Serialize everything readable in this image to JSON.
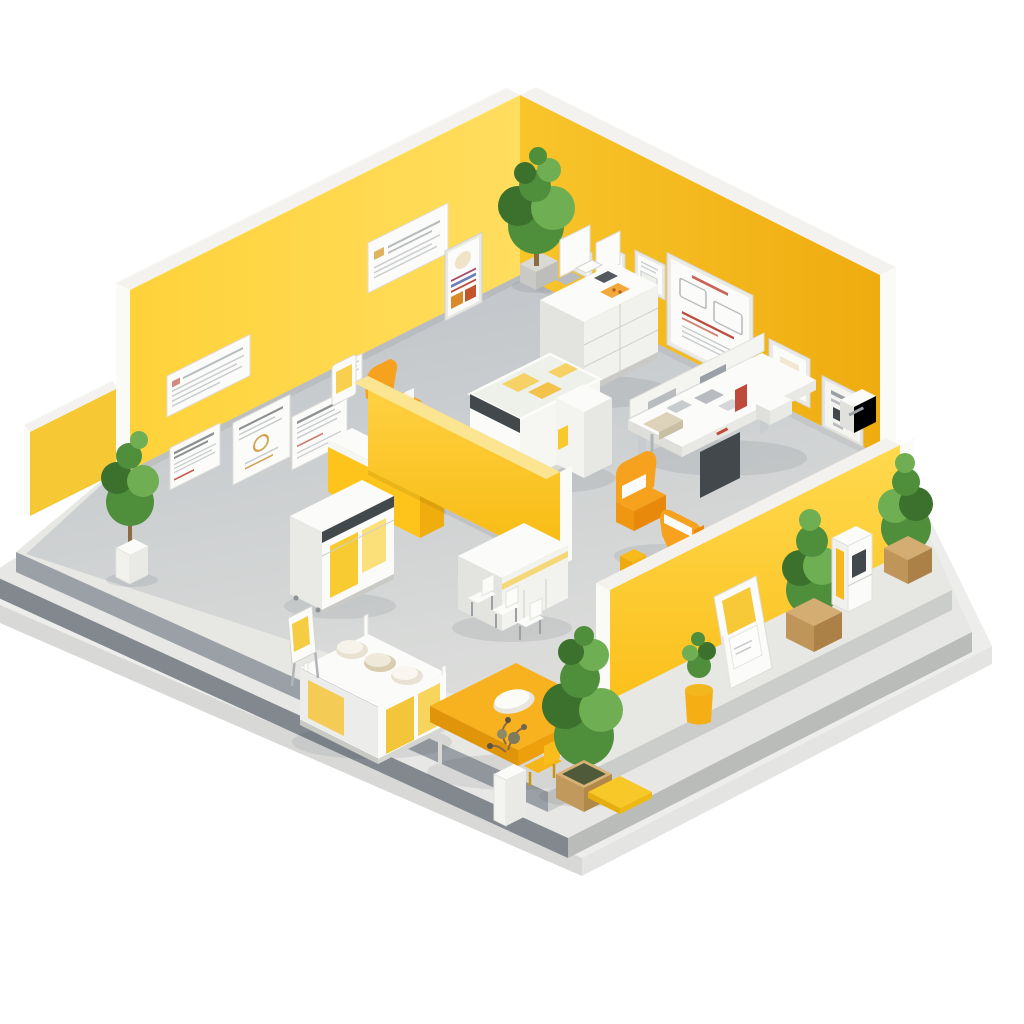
{
  "scene": {
    "title": "Isometric cutaway 3D render of a yellow showroom interior",
    "description": "Miniature isometric room on a stepped gray plinth: two tall yellow back walls with posters, certificates and a display board; a lower yellow front wall seen from outside with leaning sign, planters and kiosks on a walkway; interior with reception desk, glass display counter, drawer cabinet with gadgets, work bench, orange armchairs, vending kiosk, long table with cushions, seating counter, yellow desk and decorative trees.",
    "style": "isometric-3d-render",
    "visible_text": "none (poster and sign text is illegible pseudo-text)"
  },
  "palette": {
    "bg": "#ffffff",
    "wall-left": "#FFD84B",
    "wall-right": "#F5BC22",
    "wall-front": "#FFD23C",
    "wall-stub": "#F6C833",
    "partition": "#FFC92B",
    "cap-white": "#F3F2EE",
    "cut-white": "#FAFAF7",
    "white": "#FBFBF9",
    "white-shade": "#E9E9E6",
    "walkway": "#E7E7E4",
    "step-dark": "#82888D",
    "step-mid": "#9AA0A5",
    "floor-top": "#C2C6CA",
    "floor-bottom": "#DCDDDB",
    "accent": "#F6A21E",
    "accent-deep": "#E8890B",
    "yellow-item": "#F7C92C",
    "green": "#4F8F3B",
    "green-dark": "#3C712D",
    "green-light": "#6FAE52",
    "wood": "#C79D62",
    "wood-dark": "#A97F45",
    "detail-red": "#BF4A3A",
    "detail-dark": "#43484D",
    "line-gray": "#B9BCBE"
  },
  "objects": [
    {
      "id": "platform",
      "label": "stepped gray plinth platform"
    },
    {
      "id": "floor",
      "label": "gray concrete interior floor"
    },
    {
      "id": "wall-left",
      "label": "back-left yellow wall with posters"
    },
    {
      "id": "wall-right",
      "label": "back-right yellow wall with frames and display board"
    },
    {
      "id": "wall-front",
      "label": "front-right yellow wall seen from outside"
    },
    {
      "id": "partition",
      "label": "half-height yellow partition wall"
    },
    {
      "id": "reception",
      "label": "reception desk with orange office chair"
    },
    {
      "id": "cabinet",
      "label": "white drawer cabinet with gadgets"
    },
    {
      "id": "workbench",
      "label": "work bench with instruments and red device"
    },
    {
      "id": "display-counter",
      "label": "glass-top display counter with yellow products"
    },
    {
      "id": "armchairs",
      "label": "two orange armchairs with white cushions"
    },
    {
      "id": "kiosk",
      "label": "white vending kiosk with yellow panels"
    },
    {
      "id": "seating-counter",
      "label": "white counter with three chairs"
    },
    {
      "id": "long-table",
      "label": "long white table with beige cushions"
    },
    {
      "id": "easel",
      "label": "small easel board"
    },
    {
      "id": "yellow-desk",
      "label": "yellow desk with white cushion and chair"
    },
    {
      "id": "tree",
      "label": "tall tree in wooden planter"
    },
    {
      "id": "corner-plant",
      "label": "tall plant at back corner"
    },
    {
      "id": "left-plant",
      "label": "potted plant at left entrance"
    },
    {
      "id": "sign",
      "label": "leaning sidewalk sign"
    },
    {
      "id": "walkway-planters",
      "label": "wooden planters with bushes on walkway"
    },
    {
      "id": "station",
      "label": "small white kiosk station on walkway"
    },
    {
      "id": "posters",
      "label": "white posters with illegible text"
    },
    {
      "id": "board",
      "label": "large framed display board with sketch"
    },
    {
      "id": "wall-device",
      "label": "built-in wall device panel"
    }
  ]
}
